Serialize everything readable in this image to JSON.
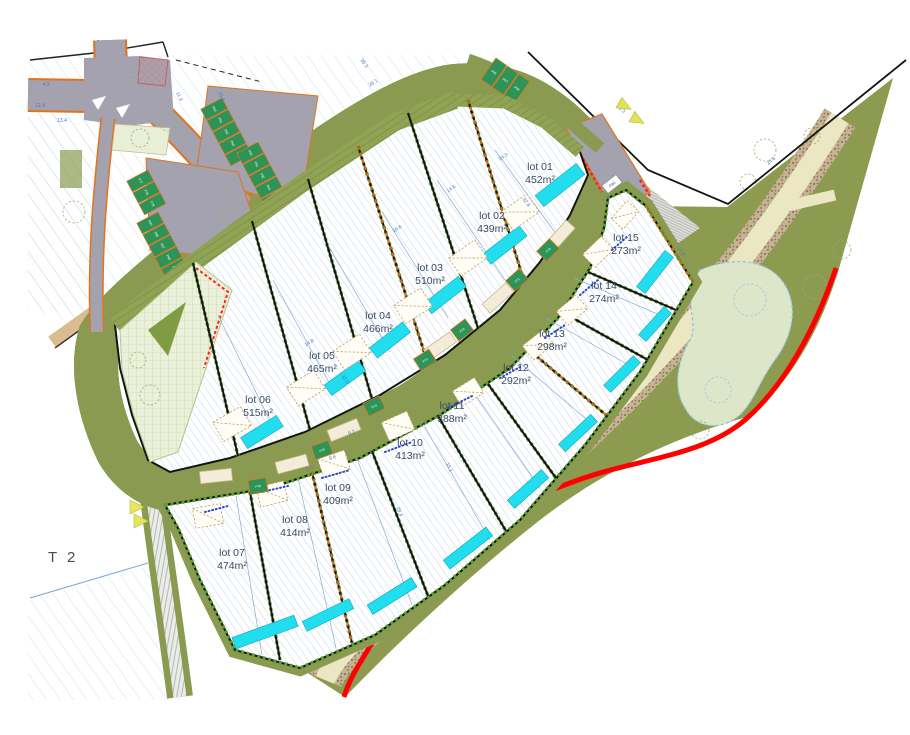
{
  "labels": {
    "t2": "T 2"
  },
  "lots": [
    {
      "name": "lot 01",
      "area": "452m²"
    },
    {
      "name": "lot 02",
      "area": "439m²"
    },
    {
      "name": "lot 03",
      "area": "510m²"
    },
    {
      "name": "lot 04",
      "area": "466m²"
    },
    {
      "name": "lot 05",
      "area": "465m²"
    },
    {
      "name": "lot 06",
      "area": "515m²"
    },
    {
      "name": "lot 07",
      "area": "474m²"
    },
    {
      "name": "lot 08",
      "area": "414m²"
    },
    {
      "name": "lot 09",
      "area": "409m²"
    },
    {
      "name": "lot 10",
      "area": "413m²"
    },
    {
      "name": "lot 11",
      "area": "388m²"
    },
    {
      "name": "lot 12",
      "area": "292m²"
    },
    {
      "name": "lot 13",
      "area": "298m²"
    },
    {
      "name": "lot 14",
      "area": "274m²"
    },
    {
      "name": "lot 15",
      "area": "273m²"
    }
  ],
  "parking": {
    "rowA": [
      "P60",
      "P61",
      "P62",
      "P63",
      "P64"
    ],
    "rowB": [
      "P90",
      "P91",
      "P92",
      "P93",
      "P94"
    ],
    "rowC": [
      "P77",
      "P78",
      "P79"
    ],
    "rowD": [
      "P85",
      "P86",
      "P87",
      "P88",
      "P89"
    ],
    "roadside": [
      "P66",
      "P67",
      "P68"
    ],
    "garages": [
      "P70",
      "P71",
      "P72",
      "P73",
      "P74",
      "P75",
      "P76"
    ],
    "end_marker": "P80"
  },
  "dims": [
    "24.6",
    "4.3",
    "12.4",
    "13.4",
    "11.9",
    "15.9",
    "36.3",
    "28.1",
    "36.3",
    "14.3",
    "32.8",
    "14.6",
    "16.6",
    "9.2",
    "8.6",
    "5.0",
    "15.1",
    "28.4",
    "16.8",
    "14.8",
    "32.0"
  ],
  "colors": {
    "road": "#a3a2ae",
    "road_edge": "#e2731e",
    "verge": "#8a9b51",
    "park": "#8d9b51",
    "lot_fill": "#ffffff",
    "hatch": "#bdd0e9",
    "boundary": "#141414",
    "hedge": "#5d9e2f",
    "pool": "#21dded",
    "stall": "#2e9356",
    "path": "#ece7c3",
    "sand": "#d9bc8f",
    "pond": "#dde6c8",
    "red_boundary": "#ff0000",
    "label": "#3b4a63",
    "dim": "#4a79c8"
  }
}
